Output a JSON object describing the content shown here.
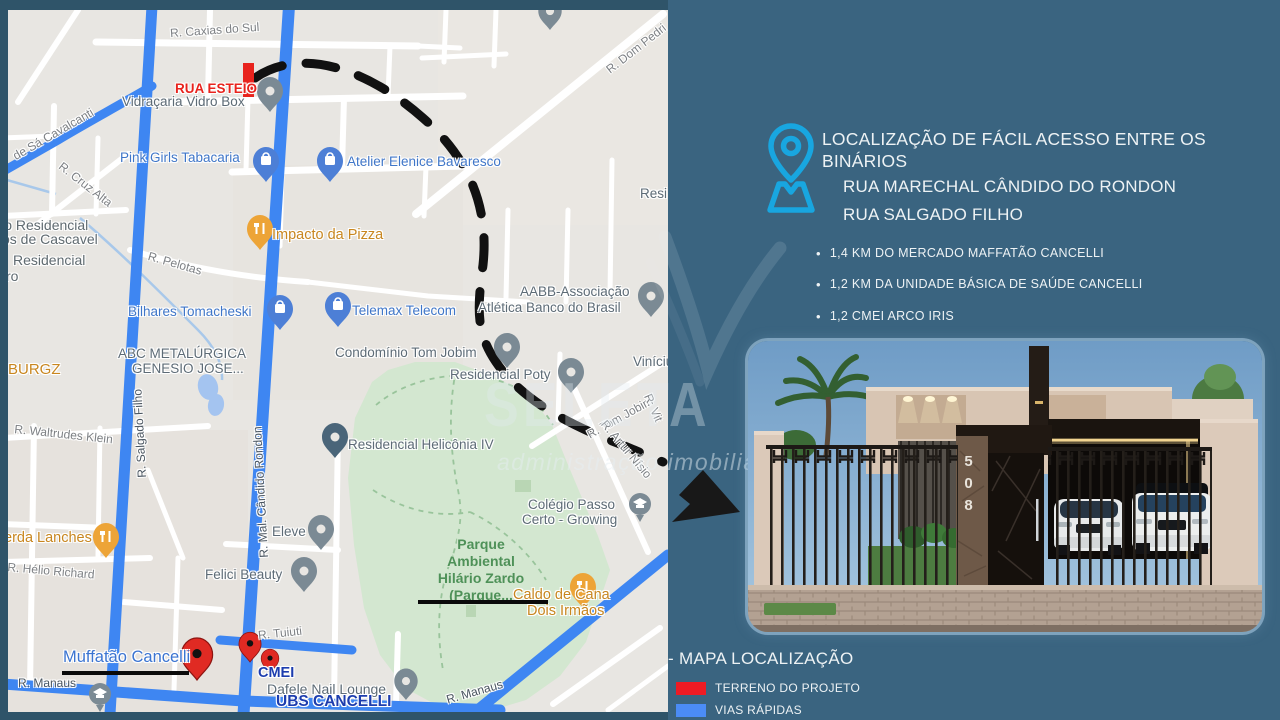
{
  "map": {
    "streets": {
      "caxias": "R. Caxias do Sul",
      "esteio": "RUA ESTEIO",
      "cavalcanti": "de Sá Cavalcanti",
      "cruz_alta": "R. Cruz Alta",
      "pelotas": "R. Pelotas",
      "waltrudes": "R. Waltrudes Klein",
      "salgado": "R. Salgado Filho",
      "rondon": "R. Mal. Cândido Rondon",
      "helio": "R. Hélio Richard",
      "dom_pedro": "R. Dom Pedri",
      "tom_jobim": "R. Tom Jobim",
      "artur_nisio": "R. Artur Nísio",
      "vit": "R. Vit",
      "tuiuti": "R. Tuiuti",
      "manaus_1": "R. Manaus",
      "manaus_2": "R. Manaus"
    },
    "pois": {
      "vidracaria": "Vidraçaria Vidro Box",
      "pink_girls": "Pink Girls Tabacaria",
      "atelier": "Atelier Elenice Bavaresco",
      "impacto": "Impacto da Pizza",
      "bilhares": "Bilhares Tomacheski",
      "telemax": "Telemax Telecom",
      "aabb_1": "AABB-Associação",
      "aabb_2": "Atlética Banco do Brasil",
      "abc_1": "ABC METALÚRGICA",
      "abc_2": "GENESIO JOSE...",
      "burgz": "BURGZ",
      "condominio_tj": "Condomínio Tom Jobim",
      "poty": "Residencial Poty",
      "vinicius": "Vinícius",
      "heliconia": "Residencial Helicônia IV",
      "eleve": "Eleve",
      "felici": "Felici Beauty",
      "colegio_1": "Colégio Passo",
      "colegio_2": "Certo - Growing",
      "caldo_1": "Caldo de Cana",
      "caldo_2": "Dois Irmãos",
      "lanches": "erda Lanches",
      "muffatao": "Muffatão Cancelli",
      "cmei": "CMEI",
      "dafele": "Dafele Nail Lounge",
      "ubs": "UBS CANCELLI",
      "resid_1": "omínio Residencial",
      "resid_2": "os de Cascavel",
      "resid_3": "Residencial",
      "resid_4": "ro",
      "resi": "Resi",
      "park_1": "Parque",
      "park_2": "Ambiental",
      "park_3": "Hilário Zardo",
      "park_4": "(Parque..."
    }
  },
  "panel": {
    "heading_1": "LOCALIZAÇÃO DE FÁCIL ACESSO  ENTRE OS",
    "heading_2": "BINÁRIOS",
    "road_1": "RUA MARECHAL CÂNDIDO DO RONDON",
    "road_2": "RUA SALGADO FILHO",
    "bullets": [
      "1,4 KM DO  MERCADO MAFFATÃO CANCELLI",
      "1,2 KM DA UNIDADE BÁSICA DE SAÚDE CANCELLI",
      "1,2 CMEI ARCO IRIS"
    ],
    "house_number": "508",
    "map_title": "- MAPA LOCALIZAÇÃO",
    "legend": [
      {
        "label": "TERRENO DO PROJETO",
        "color": "#ee1b24"
      },
      {
        "label": "VIAS RÁPIDAS",
        "color": "#4b8cf6"
      }
    ]
  },
  "watermark": {
    "name": "SELETA",
    "tagline": "administração imobiliária"
  },
  "colors": {
    "panel_bg": "#3a6480",
    "accent_cyan": "#18a6e0",
    "vias_blue": "#3e86f2",
    "terreno_red": "#e8231d"
  }
}
